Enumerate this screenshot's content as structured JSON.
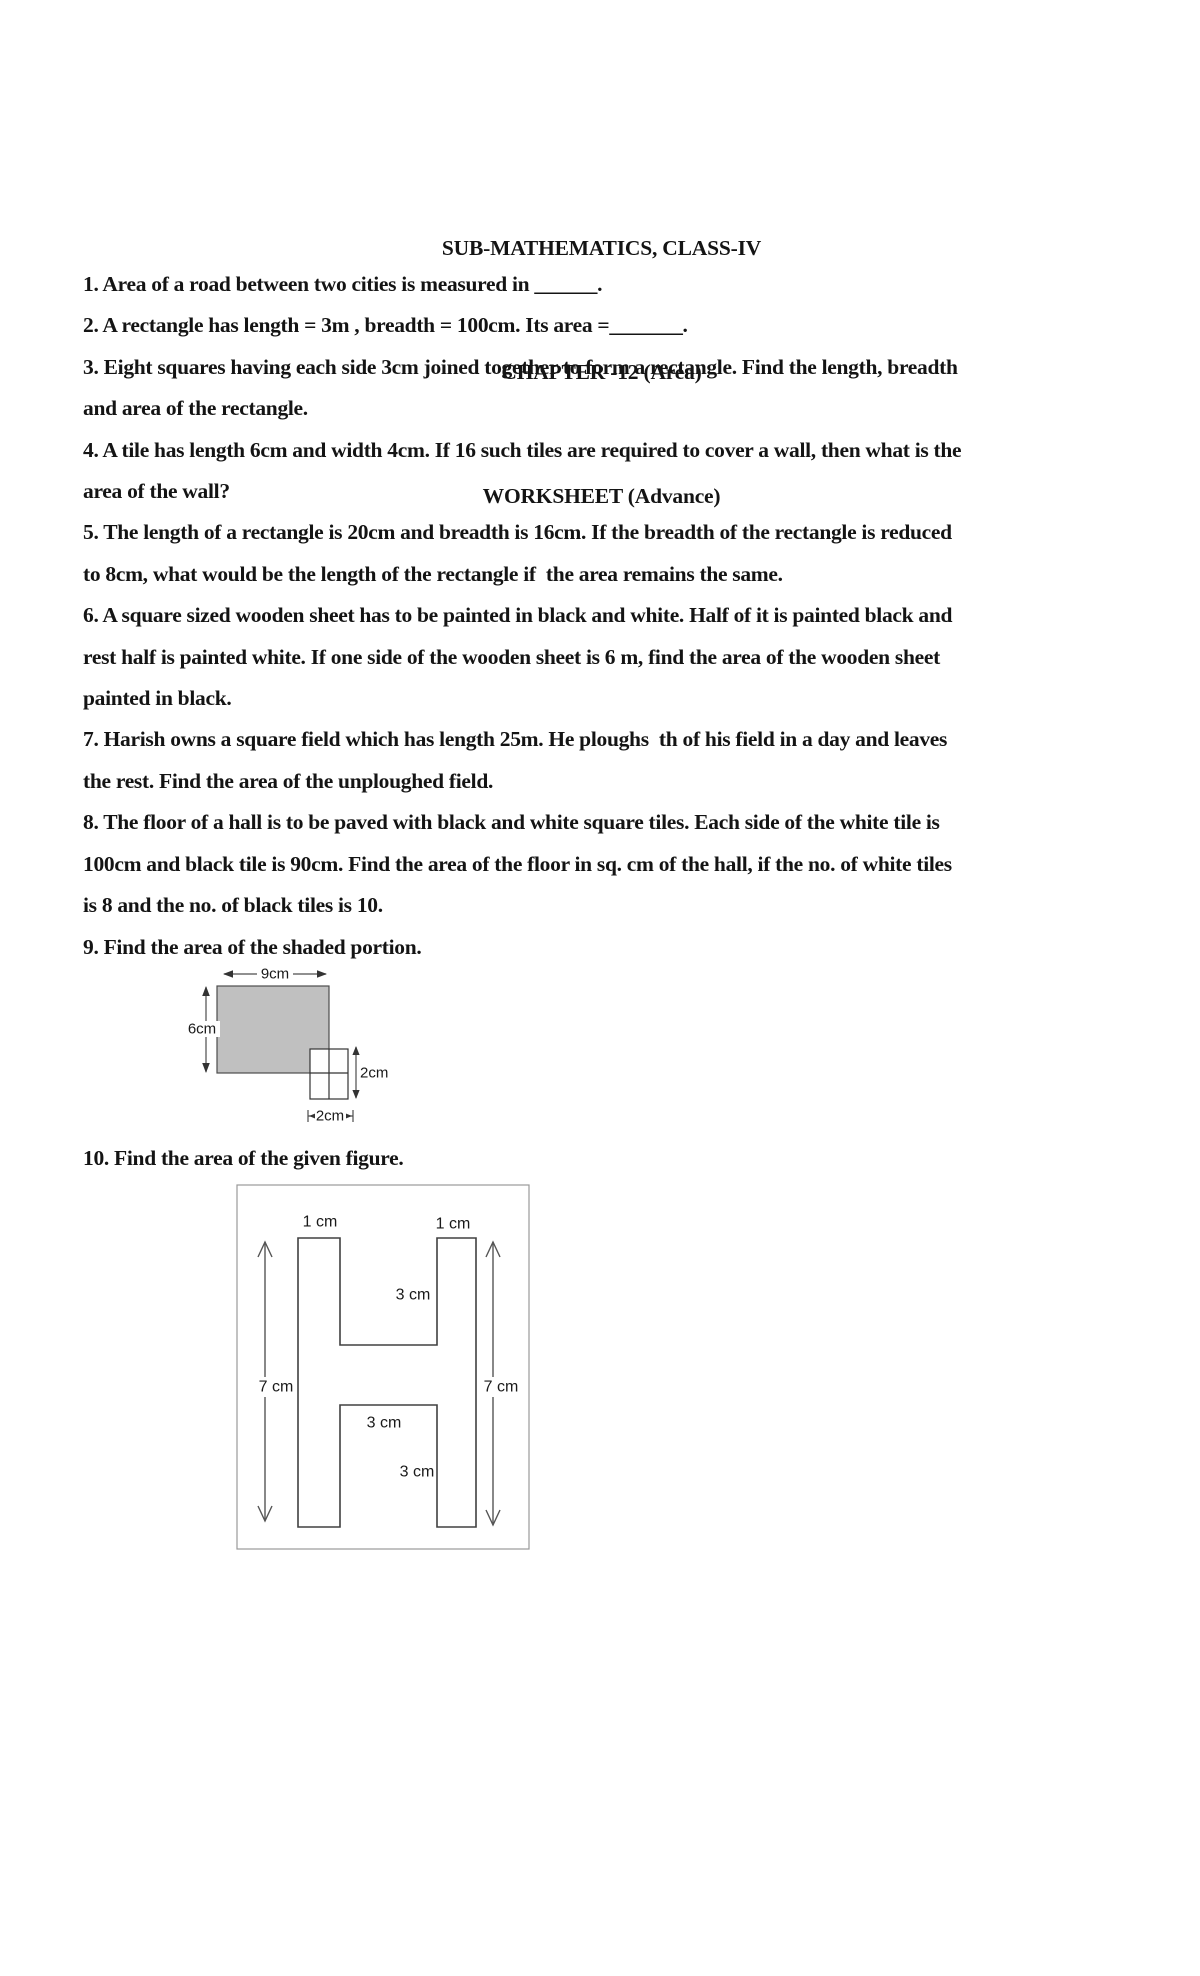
{
  "page": {
    "background": "#ffffff"
  },
  "header": {
    "title": "SUB-MATHEMATICS, CLASS-IV",
    "chapter": "CHAPTER -12 (Area)",
    "subtitle": "WORKSHEET (Advance)"
  },
  "body_lines": [
    "1. Area of a road between two cities is measured in ______.",
    "2. A rectangle has length = 3m , breadth = 100cm. Its area =_______.",
    "3. Eight squares having each side 3cm joined together to form a rectangle. Find the length, breadth",
    "and area of the rectangle.",
    "4. A tile has length 6cm and width 4cm. If 16 such tiles are required to cover a wall, then what is the",
    "area of the wall?",
    "5. The length of a rectangle is 20cm and breadth is 16cm. If the breadth of the rectangle is reduced",
    "to 8cm, what would be the length of the rectangle if  the area remains the same.",
    "6. A square sized wooden sheet has to be painted in black and white. Half of it is painted black and",
    "rest half is painted white. If one side of the wooden sheet is 6 m, find the area of the wooden sheet",
    "painted in black.",
    "7. Harish owns a square field which has length 25m. He ploughs  th of his field in a day and leaves",
    "the rest. Find the area of the unploughed field.",
    "8. The floor of a hall is to be paved with black and white square tiles. Each side of the white tile is",
    "100cm and black tile is 90cm. Find the area of the floor in sq. cm of the hall, if the no. of white tiles",
    "is 8 and the no. of black tiles is 10.",
    "9. Find the area of the shaded portion."
  ],
  "question10": "10. Find the area of the given figure.",
  "figure9": {
    "shade_color": "#c0c0c0",
    "width_label": "9cm",
    "height_label": "6cm",
    "square_height_label": "2cm",
    "square_width_label": "2cm"
  },
  "figure10": {
    "top_left_label": "1 cm",
    "top_right_label": "1 cm",
    "upper_gap_label": "3 cm",
    "left_height_label": "7 cm",
    "right_height_label": "7 cm",
    "crossbar_label": "3 cm",
    "lower_gap_label": "3 cm"
  }
}
